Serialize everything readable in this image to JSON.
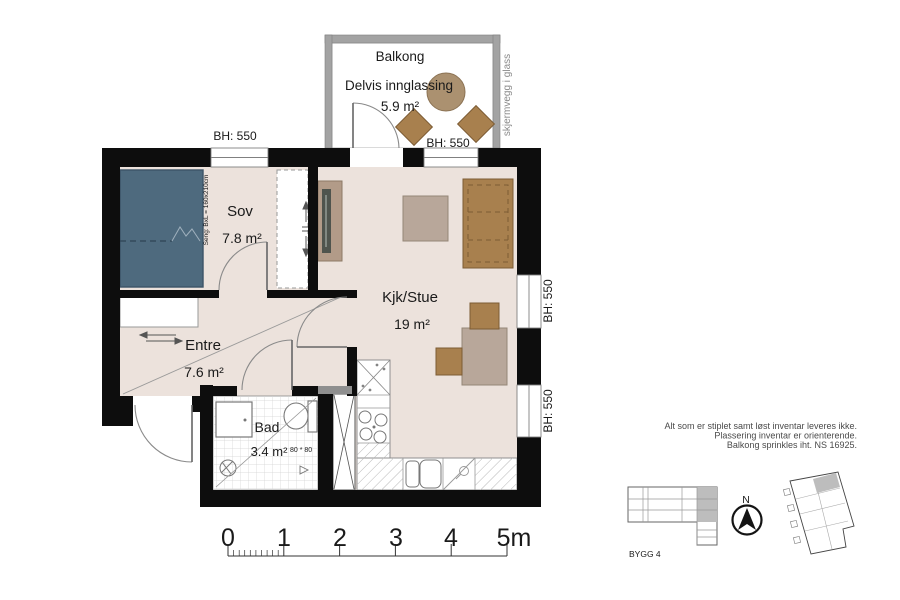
{
  "colors": {
    "wall": "#0d0d0d",
    "floor": "#ece2dc",
    "bed": "#4e6a7e",
    "furniture_wood": "#a8804e",
    "furniture_light": "#b8a79a",
    "tv_bench": "#b29b88",
    "balcony_table": "#ab9170",
    "railing": "#a3a3a3",
    "keyplan_highlight": "#bdbdbd"
  },
  "plan": {
    "balcony": {
      "title": "Balkong",
      "subtitle": "Delvis innglassing",
      "area": "5.9 m²",
      "sill_height": "BH: 550",
      "glass_note": "skjermvegg i glass"
    },
    "bedroom": {
      "title": "Sov",
      "area": "7.8 m²",
      "bed_note": "Seng: BxL = 160x210cm",
      "window_sill": "BH: 550"
    },
    "entre": {
      "title": "Entre",
      "area": "7.6 m²"
    },
    "bathroom": {
      "title": "Bad",
      "area": "3.4 m²",
      "shower_size": "80 * 80"
    },
    "living": {
      "title": "Kjk/Stue",
      "area": "19 m²",
      "window_sill_upper": "BH: 550",
      "window_sill_lower": "BH: 550"
    }
  },
  "notes": [
    "Alt som er stiplet samt løst inventar leveres ikke.",
    "Plassering inventar er orienterende.",
    "Balkong sprinkles iht. NS 16925."
  ],
  "key_plan": {
    "building_label": "BYGG 4",
    "north_label": "N"
  },
  "scale_bar": {
    "unit_ticks": [
      "0",
      "1",
      "2",
      "3",
      "4",
      "5m"
    ]
  }
}
